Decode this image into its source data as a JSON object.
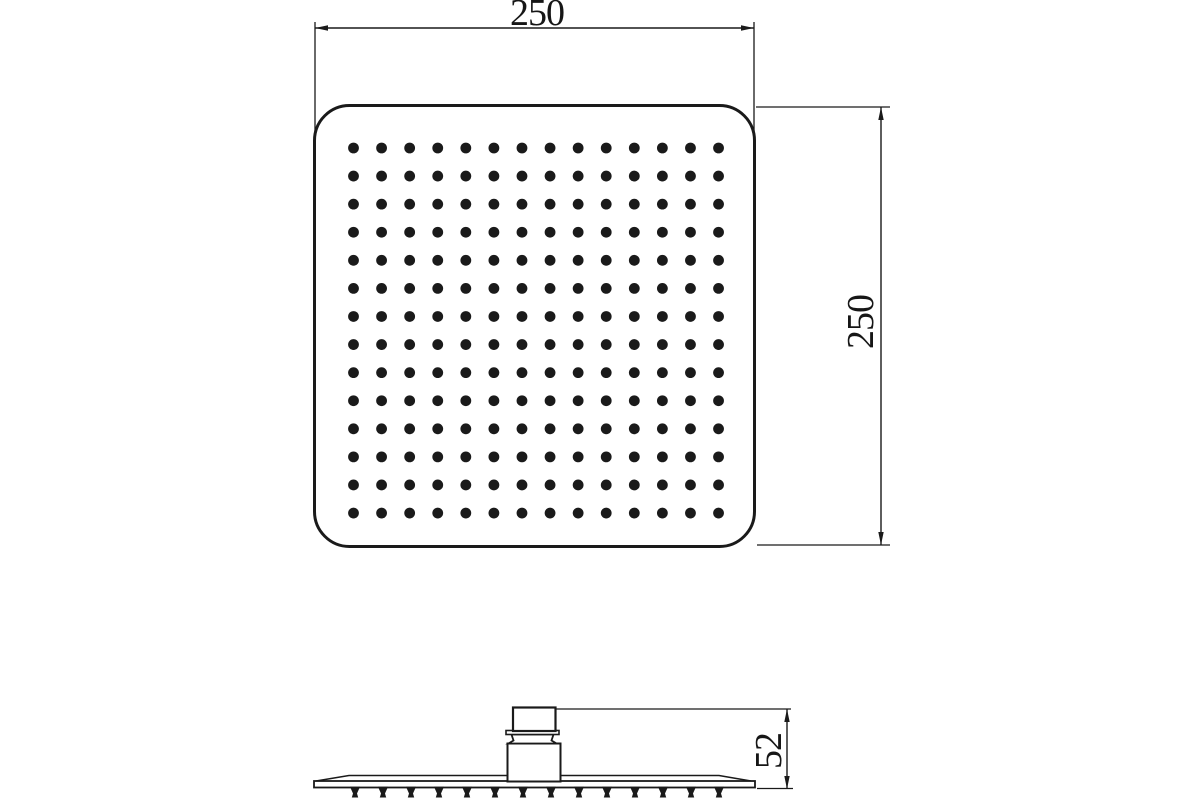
{
  "drawing": {
    "background_color": "#ffffff",
    "line_color": "#1a1a1a",
    "dimensions": {
      "top_width": "250",
      "right_height": "250",
      "side_height": "52"
    },
    "nozzle_grid": {
      "columns": 14,
      "rows": 14
    },
    "side_view": {
      "nozzle_count": 14
    }
  }
}
